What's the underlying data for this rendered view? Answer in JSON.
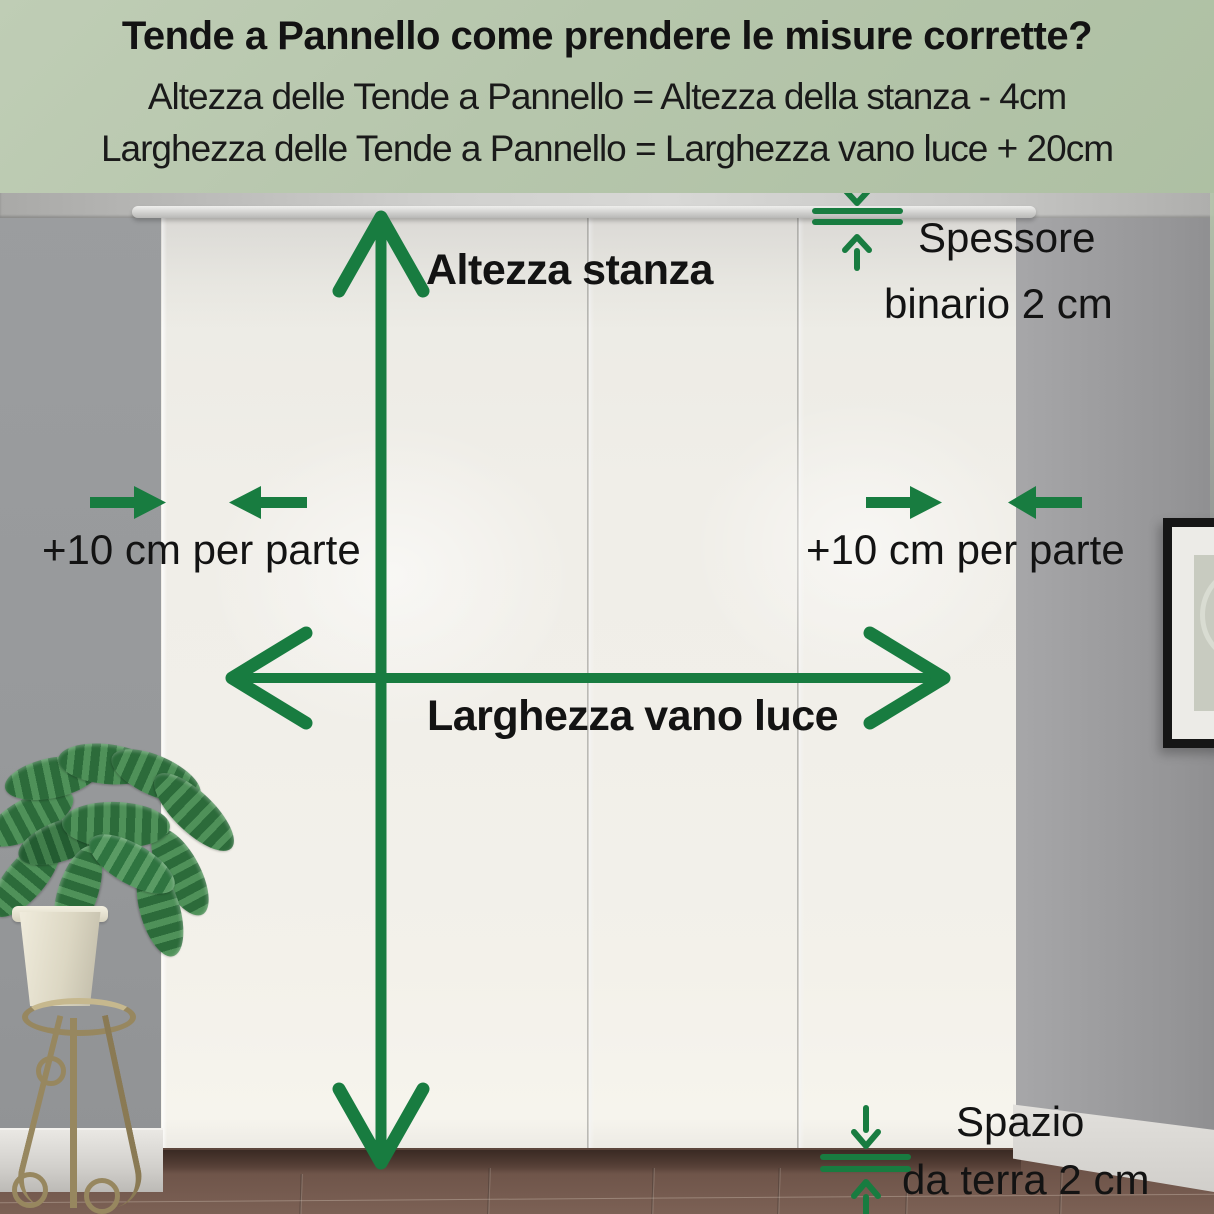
{
  "header": {
    "title": "Tende a Pannello come prendere le misure corrette?",
    "formula_height": "Altezza delle Tende a Pannello = Altezza della stanza - 4cm",
    "formula_width": "Larghezza delle Tende a Pannello = Larghezza vano luce + 20cm"
  },
  "annotations": {
    "room_height_label": "Altezza stanza",
    "window_width_label": "Larghezza vano luce",
    "left_margin_label": "+10 cm per parte",
    "right_margin_label": "+10 cm per parte",
    "rail_thickness_line1": "Spessore",
    "rail_thickness_line2": "binario 2 cm",
    "floor_gap_line1": "Spazio",
    "floor_gap_line2": "da terra 2 cm"
  },
  "colors": {
    "accent_green": "#187c40",
    "header_background": "#b6c6ac",
    "text": "#131313"
  }
}
